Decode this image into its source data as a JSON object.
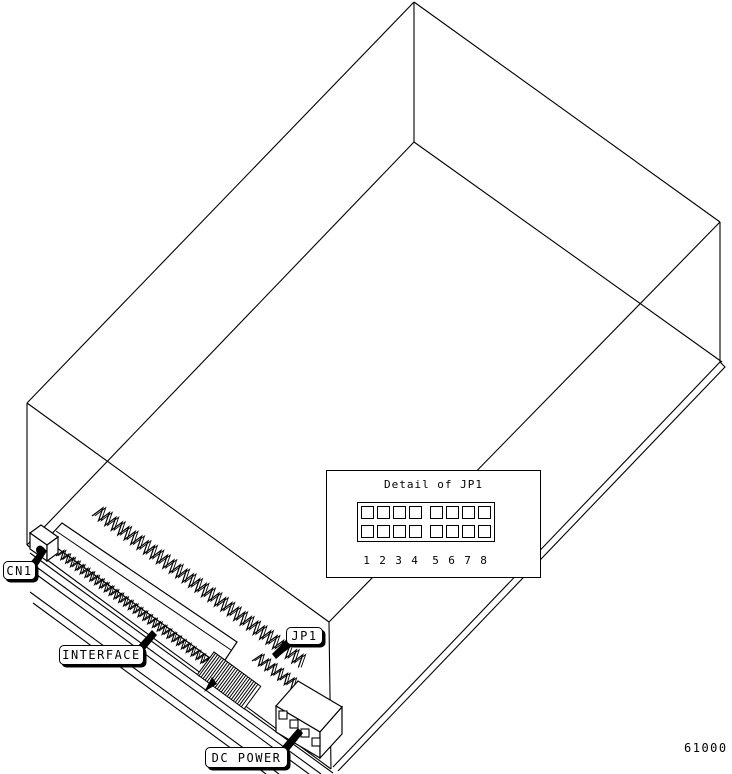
{
  "colors": {
    "line": "#000000",
    "background": "#ffffff"
  },
  "callouts": {
    "cn1": {
      "label": "CN1"
    },
    "interface": {
      "label": "INTERFACE"
    },
    "jp1": {
      "label": "JP1"
    },
    "dc_power": {
      "label": "DC POWER"
    }
  },
  "detail_inset": {
    "title": "Detail of JP1",
    "pin_rows": 2,
    "pin_columns": 8,
    "pin_numbers": [
      "1",
      "2",
      "3",
      "4",
      "5",
      "6",
      "7",
      "8"
    ]
  },
  "figure_number": "61000",
  "components": [
    "drive-wireframe",
    "cn1-connector",
    "interface-connector",
    "jp1-jumper-pins",
    "dc-power-connector",
    "jp1-detail-inset"
  ]
}
